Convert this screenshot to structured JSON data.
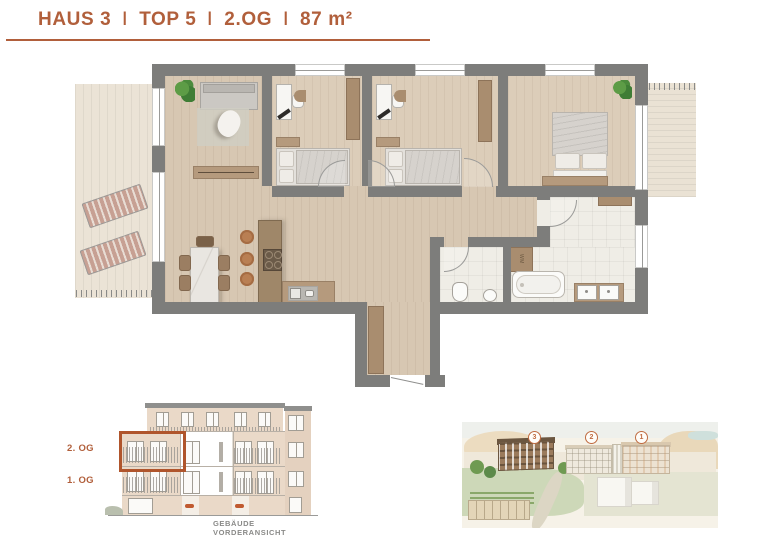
{
  "header": {
    "segments": [
      "HAUS 3",
      "TOP 5",
      "2.OG",
      "87 m²"
    ],
    "separator": "I",
    "accent_color": "#b15f3b"
  },
  "floorplan": {
    "wm_label": "WM",
    "wall_color": "#7d7d7b",
    "wood_color": "#d7c7b2",
    "tile_color": "#efede6",
    "terrace_color": "#ebe3d6"
  },
  "elevation": {
    "floor_labels": [
      {
        "label": "2. OG"
      },
      {
        "label": "1. OG"
      }
    ],
    "caption": "GEBÄUDE VORDERANSICHT",
    "highlight_color": "#b0552c"
  },
  "site": {
    "markers": [
      "3",
      "2",
      "1"
    ],
    "marker_color": "#bf6b40"
  }
}
